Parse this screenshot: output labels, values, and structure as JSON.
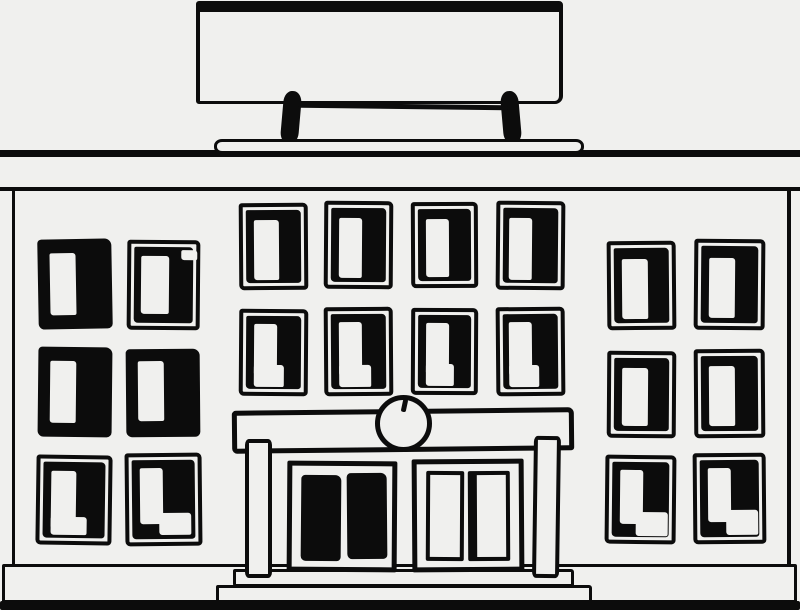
{
  "meta": {
    "description": "Hand-drawn black ink sketch of a public/school building with a blank billboard sign on the roof, three bays of dark sketchy windows, and a central columned entrance with a round clock, double doors and front steps",
    "width": 800,
    "height": 610
  },
  "palette": {
    "ink": "#0c0c0c",
    "paper": "#f0f0ee"
  },
  "layers": {
    "back": [
      {
        "name": "roof-sign-board",
        "cls": "sign-board",
        "x": 196,
        "y": 1,
        "w": 367,
        "h": 103,
        "rot": 0
      },
      {
        "name": "roof-sign-post-left",
        "cls": "ink",
        "x": 282,
        "y": 91,
        "w": 18,
        "h": 53,
        "rot": 5
      },
      {
        "name": "roof-sign-post-right",
        "cls": "ink",
        "x": 502,
        "y": 91,
        "w": 18,
        "h": 53,
        "rot": -5
      },
      {
        "name": "roof-sign-crossbar",
        "cls": "ink-line",
        "x": 298,
        "y": 104,
        "w": 210,
        "h": 5,
        "rot": 0.7
      },
      {
        "name": "roof-band",
        "cls": "band",
        "x": 0,
        "y": 150,
        "w": 800,
        "h": 41,
        "rot": 0
      },
      {
        "name": "roof-platform",
        "cls": "slab",
        "x": 214,
        "y": 139,
        "w": 370,
        "h": 15,
        "rot": 0
      },
      {
        "name": "building-facade",
        "cls": "facade",
        "x": 12,
        "y": 189,
        "w": 779,
        "h": 379,
        "rot": 0
      },
      {
        "name": "base-strip",
        "cls": "base",
        "x": 2,
        "y": 564,
        "w": 795,
        "h": 40,
        "rot": 0
      },
      {
        "name": "ground-band",
        "cls": "ground",
        "x": 0,
        "y": 601,
        "w": 800,
        "h": 9,
        "rot": 0
      },
      {
        "name": "entrance-step-lower",
        "cls": "step",
        "x": 216,
        "y": 585,
        "w": 376,
        "h": 18,
        "rot": 0
      },
      {
        "name": "entrance-step-upper",
        "cls": "step",
        "x": 233,
        "y": 569,
        "w": 341,
        "h": 18,
        "rot": 0
      }
    ],
    "front": [
      {
        "name": "entrance-canopy",
        "cls": "canopy",
        "x": 232,
        "y": 409,
        "w": 342,
        "h": 43,
        "rot": -0.6
      },
      {
        "name": "entrance-pillar-left",
        "cls": "pillar",
        "x": 245,
        "y": 439,
        "w": 27,
        "h": 139,
        "rot": 0
      },
      {
        "name": "entrance-pillar-right",
        "cls": "pillar",
        "x": 533,
        "y": 436,
        "w": 27,
        "h": 142,
        "rot": 0.8
      },
      {
        "name": "doorway-frame-left",
        "cls": "doorframe",
        "x": 287,
        "y": 461,
        "w": 110,
        "h": 111,
        "rot": 0.4
      },
      {
        "name": "doorway-frame-right",
        "cls": "doorframe",
        "x": 412,
        "y": 459,
        "w": 112,
        "h": 113,
        "rot": -0.4
      },
      {
        "name": "door-panel-left-a",
        "cls": "door-ink",
        "x": 301,
        "y": 475,
        "w": 40,
        "h": 86,
        "rot": 0.5
      },
      {
        "name": "door-panel-left-b",
        "cls": "door-ink",
        "x": 347,
        "y": 473,
        "w": 40,
        "h": 86,
        "rot": -0.5
      },
      {
        "name": "door-panel-right-a",
        "cls": "door-paper",
        "x": 426,
        "y": 471,
        "w": 38,
        "h": 90,
        "rot": 0.3
      },
      {
        "name": "door-panel-right-b",
        "cls": "door-paper-thick",
        "x": 468,
        "y": 471,
        "w": 42,
        "h": 90,
        "rot": -0.3
      },
      {
        "name": "entrance-clock-face",
        "cls": "clock",
        "x": 375,
        "y": 395,
        "w": 57,
        "h": 57,
        "rot": 0
      },
      {
        "name": "entrance-clock-hand",
        "cls": "tick",
        "x": 402,
        "y": 399,
        "w": 5,
        "h": 13,
        "rot": 12
      }
    ]
  },
  "windows": [
    {
      "id": "left-r1-c1",
      "style": "solid",
      "x": 38,
      "y": 239,
      "w": 74,
      "h": 90,
      "rot": -1,
      "panes": [
        [
          12,
          14,
          26,
          62
        ]
      ]
    },
    {
      "id": "left-r1-c2",
      "style": "framed",
      "x": 127,
      "y": 240,
      "w": 73,
      "h": 90,
      "rot": 0.5,
      "panes": [
        [
          10,
          12,
          28,
          58
        ],
        [
          50,
          6,
          16,
          10
        ]
      ]
    },
    {
      "id": "left-r2-c1",
      "style": "solid",
      "x": 38,
      "y": 347,
      "w": 74,
      "h": 90,
      "rot": 0.6,
      "panes": [
        [
          12,
          14,
          26,
          62
        ]
      ]
    },
    {
      "id": "left-r2-c2",
      "style": "solid",
      "x": 126,
      "y": 349,
      "w": 74,
      "h": 88,
      "rot": -0.5,
      "panes": [
        [
          12,
          12,
          26,
          60
        ]
      ]
    },
    {
      "id": "left-r3-c1",
      "style": "framed",
      "x": 36,
      "y": 455,
      "w": 76,
      "h": 90,
      "rot": 0.8,
      "panes": [
        [
          11,
          12,
          25,
          58
        ],
        [
          11,
          58,
          36,
          18
        ]
      ]
    },
    {
      "id": "left-r3-c2",
      "style": "framed",
      "x": 125,
      "y": 453,
      "w": 77,
      "h": 93,
      "rot": -0.6,
      "panes": [
        [
          11,
          11,
          23,
          56
        ],
        [
          30,
          56,
          32,
          22
        ]
      ]
    },
    {
      "id": "center-r1-c1",
      "style": "framed",
      "x": 239,
      "y": 203,
      "w": 69,
      "h": 87,
      "rot": -0.4,
      "panes": [
        [
          11,
          13,
          25,
          60
        ]
      ]
    },
    {
      "id": "center-r1-c2",
      "style": "framed",
      "x": 324,
      "y": 201,
      "w": 69,
      "h": 88,
      "rot": 0.4,
      "panes": [
        [
          11,
          13,
          23,
          60
        ]
      ]
    },
    {
      "id": "center-r1-c3",
      "style": "framed",
      "x": 411,
      "y": 202,
      "w": 67,
      "h": 86,
      "rot": -0.3,
      "panes": [
        [
          11,
          13,
          23,
          58
        ]
      ]
    },
    {
      "id": "center-r1-c4",
      "style": "framed",
      "x": 496,
      "y": 201,
      "w": 69,
      "h": 89,
      "rot": 0.5,
      "panes": [
        [
          9,
          13,
          23,
          62
        ]
      ]
    },
    {
      "id": "center-r2-c1",
      "style": "framed",
      "x": 239,
      "y": 309,
      "w": 69,
      "h": 87,
      "rot": 0.4,
      "panes": [
        [
          11,
          11,
          23,
          52
        ],
        [
          11,
          52,
          30,
          22
        ]
      ]
    },
    {
      "id": "center-r2-c2",
      "style": "framed",
      "x": 324,
      "y": 307,
      "w": 69,
      "h": 89,
      "rot": -0.4,
      "panes": [
        [
          11,
          11,
          23,
          54
        ],
        [
          11,
          54,
          32,
          22
        ]
      ]
    },
    {
      "id": "center-r2-c3",
      "style": "framed",
      "x": 411,
      "y": 308,
      "w": 67,
      "h": 87,
      "rot": 0.3,
      "panes": [
        [
          11,
          11,
          23,
          52
        ],
        [
          11,
          52,
          28,
          22
        ]
      ]
    },
    {
      "id": "center-r2-c4",
      "style": "framed",
      "x": 496,
      "y": 307,
      "w": 69,
      "h": 89,
      "rot": -0.5,
      "panes": [
        [
          9,
          11,
          23,
          54
        ],
        [
          9,
          54,
          30,
          22
        ]
      ]
    },
    {
      "id": "right-r1-c1",
      "style": "framed",
      "x": 607,
      "y": 241,
      "w": 69,
      "h": 89,
      "rot": -0.5,
      "panes": [
        [
          11,
          14,
          26,
          60
        ]
      ]
    },
    {
      "id": "right-r1-c2",
      "style": "framed",
      "x": 694,
      "y": 239,
      "w": 71,
      "h": 91,
      "rot": 0.5,
      "panes": [
        [
          11,
          15,
          26,
          60
        ]
      ]
    },
    {
      "id": "right-r2-c1",
      "style": "framed",
      "x": 607,
      "y": 351,
      "w": 69,
      "h": 87,
      "rot": 0.4,
      "panes": [
        [
          11,
          13,
          26,
          58
        ]
      ]
    },
    {
      "id": "right-r2-c2",
      "style": "framed",
      "x": 694,
      "y": 349,
      "w": 71,
      "h": 89,
      "rot": -0.4,
      "panes": [
        [
          11,
          13,
          26,
          60
        ]
      ]
    },
    {
      "id": "right-r3-c1",
      "style": "framed",
      "x": 605,
      "y": 455,
      "w": 71,
      "h": 89,
      "rot": 0.6,
      "panes": [
        [
          11,
          11,
          23,
          54
        ],
        [
          27,
          53,
          32,
          24
        ]
      ]
    },
    {
      "id": "right-r3-c2",
      "style": "framed",
      "x": 693,
      "y": 453,
      "w": 73,
      "h": 91,
      "rot": -0.5,
      "panes": [
        [
          29,
          53,
          32,
          25
        ],
        [
          11,
          11,
          23,
          54
        ]
      ]
    }
  ]
}
